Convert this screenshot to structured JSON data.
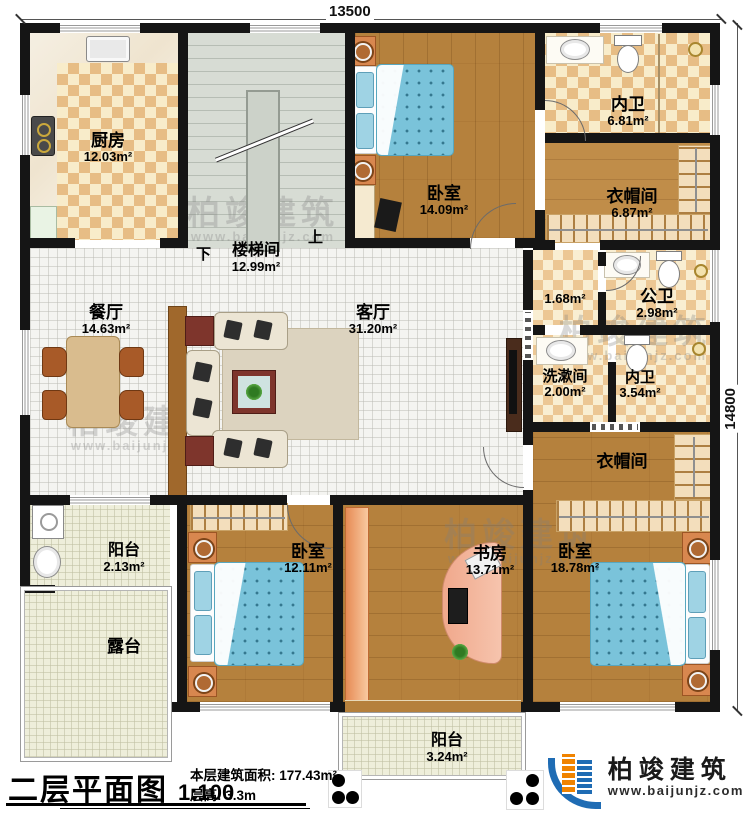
{
  "titleblock": {
    "title": "二层平面图",
    "scale": "1:100",
    "area_line": "本层建筑面积: 177.43m²",
    "height_line": "层高: 3.3m"
  },
  "dims": {
    "top": "13500",
    "right": "14800"
  },
  "logo": {
    "brand": "柏竣建筑",
    "site": "www.baijunjz.com"
  },
  "watermark": {
    "text": "柏竣建筑",
    "url": "www.baijunjz.com"
  },
  "stairs": {
    "up": "上",
    "down": "下"
  },
  "rooms": [
    {
      "name": "厨房",
      "area": "12.03m²"
    },
    {
      "name": "楼梯间",
      "area": "12.99m²"
    },
    {
      "name": "卧室",
      "area": "14.09m²"
    },
    {
      "name": "内卫",
      "area": "6.81m²"
    },
    {
      "name": "衣帽间",
      "area": "6.87m²"
    },
    {
      "name": "餐厅",
      "area": "14.63m²"
    },
    {
      "name": "客厅",
      "area": "31.20m²"
    },
    {
      "name": "",
      "area": "1.68m²"
    },
    {
      "name": "公卫",
      "area": "2.98m²"
    },
    {
      "name": "洗漱间",
      "area": "2.00m²"
    },
    {
      "name": "内卫",
      "area": "3.54m²"
    },
    {
      "name": "衣帽间",
      "area": ""
    },
    {
      "name": "阳台",
      "area": "2.13m²"
    },
    {
      "name": "露台",
      "area": ""
    },
    {
      "name": "卧室",
      "area": "12.11m²"
    },
    {
      "name": "书房",
      "area": "13.71m²"
    },
    {
      "name": "卧室",
      "area": "18.78m²"
    },
    {
      "name": "阳台",
      "area": "3.24m²"
    }
  ]
}
